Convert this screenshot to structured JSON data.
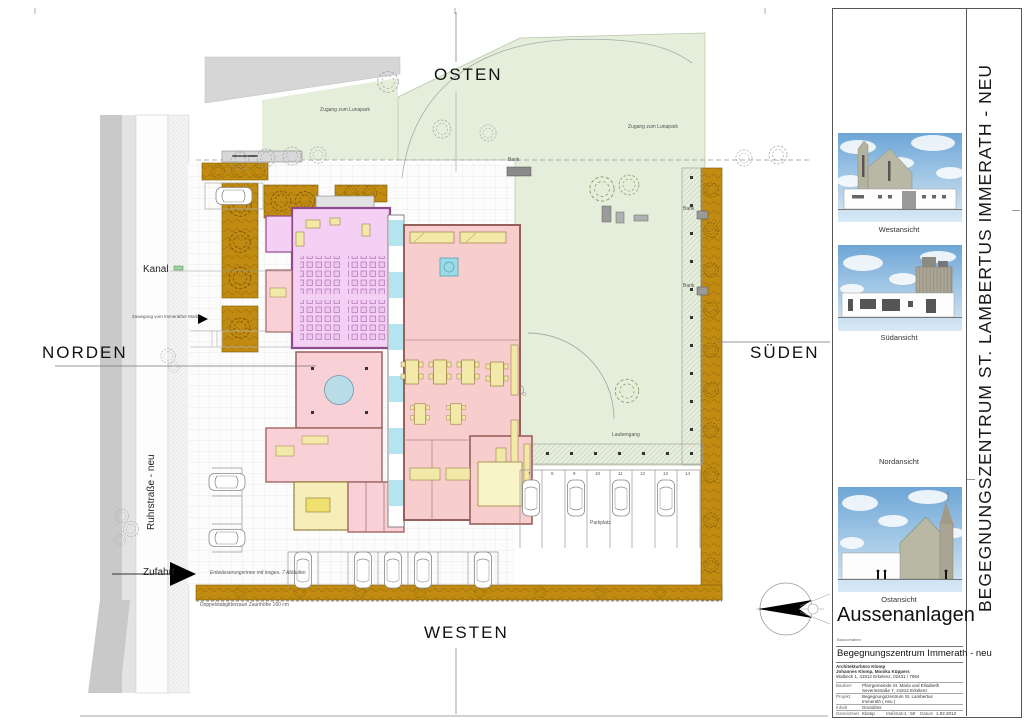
{
  "compass": {
    "north": "NORDEN",
    "east": "OSTEN",
    "south": "SÜDEN",
    "west": "WESTEN"
  },
  "site": {
    "kanal": "Kanal",
    "zuwegung": "Zuwegung vom Immerather Markt",
    "street": "Ruhrstraße - neu",
    "zufahrt": "Zufahrt",
    "lunapark_west": "Zugang zum Lunapark",
    "lunapark_east": "Zugang zum Lunapark",
    "bank_top": "Bank",
    "bank_east1": "Bank",
    "bank_east2": "Bank",
    "laubengang": "Laubengang",
    "parkplatz": "Parkplatz",
    "drain_note": "Entwässerungsrinne mit insges. 7 Abläufen",
    "fence_note": "Doppelstabgitterzaun Zaunhöhe 160 cm",
    "parking_numbers": [
      "7",
      "8",
      "9",
      "10",
      "11",
      "12",
      "13",
      "14"
    ]
  },
  "panel": {
    "elevations": [
      {
        "label": "Westansicht"
      },
      {
        "label": "Südansicht"
      },
      {
        "label": "Nordansicht"
      },
      {
        "label": "Ostansicht"
      }
    ],
    "title": "Aussenanlagen",
    "category_label": "Bauvorhaben",
    "project": "Begegnungszentrum Immerath - neu",
    "architect_line1": "Architekturbüro Klomp",
    "architect_line2": "Johannes Klomp, Monika Küppers",
    "architect_line3": "Walbeck 1, 41812 Erkelenz, 02431 / 7984",
    "rows": [
      {
        "label": "Bauherr",
        "value": "Pfarrgemeinde St. Maria und Elisabeth",
        "value2": "Severinstraße 7, 41812 Erkelenz"
      },
      {
        "label": "Projekt",
        "value": "Begegnungszentrum St. Lambertus",
        "value2": "Immerath ( neu )"
      },
      {
        "label": "Inhalt",
        "value": "Grundriss",
        "value2": ""
      }
    ],
    "footer": {
      "drawn_label": "Gezeichnet",
      "drawn": "Klomp",
      "scale_label": "Maßstab",
      "scale": "1 : 50",
      "date_label": "Datum",
      "date": "1.02.2013"
    },
    "side_title": "BEGEGNUNGSZENTRUM ST. LAMBERTUS  IMMERATH - NEU"
  },
  "colors": {
    "park_green": "#e4eeda",
    "hedge_ochre": "#c18a10",
    "hall_violet": "#f3d0f4",
    "rooms_pink": "#f8cdcd",
    "glass_cyan": "#b4e4ef",
    "furniture_yellow": "#f2e9a8",
    "sky_blue": "#6ea6d6"
  }
}
